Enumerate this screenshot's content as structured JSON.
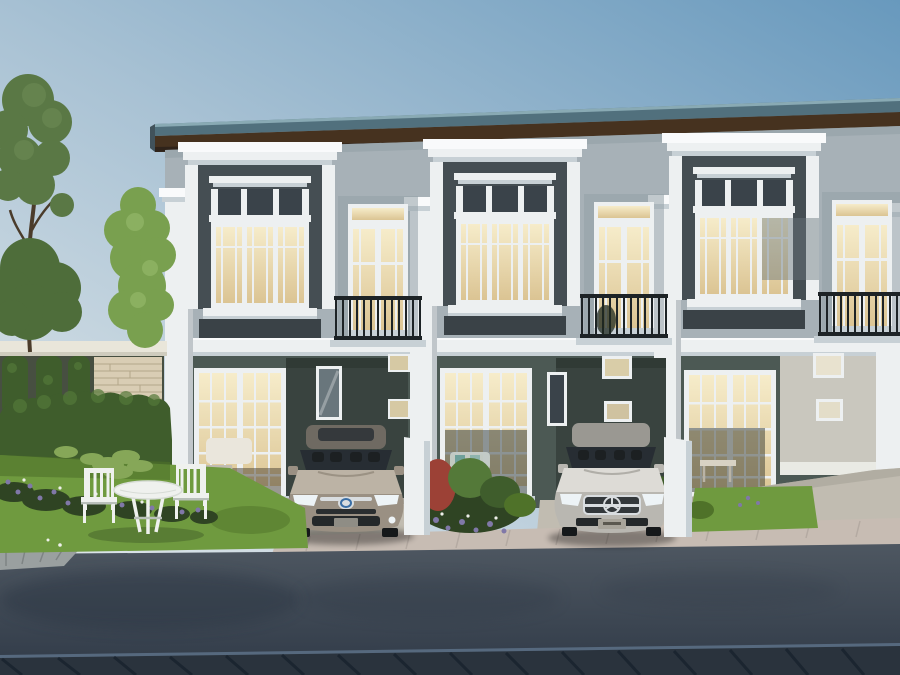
{
  "scene": {
    "title": "Two-storey townhome row — exterior rendering",
    "description": "Architectural rendering of a three-unit, two-storey townhouse row at dusk: grey facades with white classical window surrounds and cornices, charcoal window panels with warm lit glass, wrought-iron balconies, a bronze Toyota sedan and a silver Mercedes-Benz sedan parked in carports, landscaped front gardens with hedge, stone garden wall, white patio table and chairs on a lawn, and an asphalt street with a dark paver strip in the foreground.",
    "objects": {
      "building": "three-unit two-storey townhouse row",
      "car_left": "bronze Toyota sedan parked in left carport",
      "car_right": "silver Mercedes-Benz sedan parked in centre carport",
      "patio_set": "white garden table with two slat-back chairs",
      "garden": "hedge, flower bed, stone garden wall and trees",
      "street": "asphalt street with paver strip and sidewalk"
    }
  },
  "colors": {
    "sky_top": "#6899bd",
    "sky_mid": "#a9c2d4",
    "sky_low": "#e0e7ea",
    "roof_top": "#51707d",
    "roof_edge": "#8fb0ba",
    "roof_soffit": "#46321f",
    "roof_soffit_dark": "#2f231a",
    "wall_upper": "#a7b1b7",
    "wall_upper_dark": "#93a0a7",
    "panel_charcoal": "#454e53",
    "panel_charcoal_dark": "#3a4247",
    "trim_white": "#edf0f1",
    "trim_bright": "#f9fafb",
    "trim_shadow": "#c7d0d5",
    "glass_warm_hi": "#f6ecca",
    "glass_warm_lo": "#dbc493",
    "glass_dark": "#3a434a",
    "glass_cool": "#69767c",
    "railing_iron": "#1d2326",
    "wall_ground": "#4c5954",
    "wall_ground_dark": "#39433f",
    "wall_ground_light": "#c9c7be",
    "base_white": "#e9eae4",
    "drive_concrete": "#c1bcb1",
    "drive_shadow": "#98948a",
    "sidewalk": "#c7bcb3",
    "road_hi": "#4e5761",
    "road_lo": "#343e4b",
    "road_shadow": "#2b3542",
    "paver_dark": "#2a333d",
    "paver_line": "#1b2530",
    "paver_edge": "#5a6e84",
    "grass": "#6f9a3f",
    "grass_dark": "#4f7229",
    "hedge": "#3f5d2c",
    "hedge_light": "#547939",
    "tree_a": "#5a7845",
    "tree_b": "#4e6d3a",
    "tree_c": "#79a04f",
    "tree_c_light": "#90b465",
    "trunk": "#4b3c2b",
    "stone": "#d9cdb4",
    "stone_line": "#b4a68a",
    "beam": "#e9e6da",
    "pavilion_shade": "#474f41",
    "flower_purple": "#8078a8",
    "flower_white": "#eef0ea",
    "flower_red": "#9c4136",
    "foliage_dark": "#2f4423",
    "hosta_green": "#86a758",
    "car1": "#9a9083",
    "car1_light": "#bcb3a5",
    "car1_dark": "#6f6a62",
    "car2": "#b9b7b1",
    "car2_light": "#dddbd6",
    "car2_dark": "#9a9892",
    "car_glass": "#272d33",
    "chrome": "#d9dde0",
    "headlamp": "#edf3f6",
    "toyota_badge_blue": "#3a6ea5",
    "furniture": "#eff1ee",
    "furniture_shadow": "#b9c0ba"
  }
}
